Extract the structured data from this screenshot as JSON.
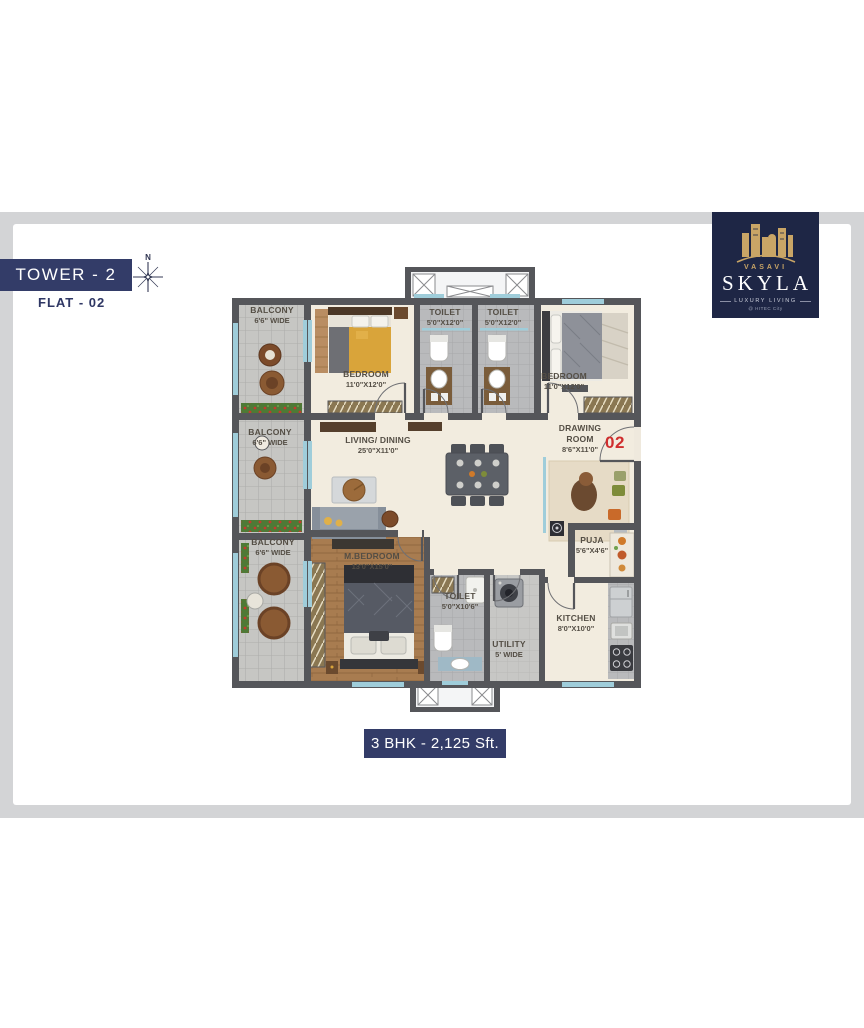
{
  "header": {
    "tower_label": "TOWER - 2",
    "flat_label": "FLAT - 02",
    "compass_north": "N"
  },
  "logo": {
    "brand": "VASAVI",
    "name": "SKYLA",
    "tagline": "LUXURY LIVING",
    "location": "@ HITEC City"
  },
  "plan": {
    "unit_number": "02",
    "rooms": {
      "balcony_top": {
        "name": "BALCONY",
        "dim": "6'6\" WIDE"
      },
      "bedroom_1": {
        "name": "BEDROOM",
        "dim": "11'0\"X12'0\""
      },
      "toilet_1": {
        "name": "TOILET",
        "dim": "5'0\"X12'0\""
      },
      "toilet_2": {
        "name": "TOILET",
        "dim": "5'0\"X12'0\""
      },
      "bedroom_2": {
        "name": "BEDROOM",
        "dim": "11'0\"X12'0\""
      },
      "balcony_mid": {
        "name": "BALCONY",
        "dim": "6'6\" WIDE"
      },
      "living_dining": {
        "name": "LIVING/ DINING",
        "dim": "25'0\"X11'0\""
      },
      "drawing_room": {
        "name": "DRAWING ROOM",
        "dim": "8'6\"X11'0\""
      },
      "balcony_bottom": {
        "name": "BALCONY",
        "dim": "6'6\" WIDE"
      },
      "master_bedroom": {
        "name": "M.BEDROOM",
        "dim": "13'0\"X15'0\""
      },
      "toilet_3": {
        "name": "TOILET",
        "dim": "5'0\"X10'6\""
      },
      "utility": {
        "name": "UTILITY",
        "dim": "5' WIDE"
      },
      "puja": {
        "name": "PUJA",
        "dim": "5'6\"X4'6\""
      },
      "kitchen": {
        "name": "KITCHEN",
        "dim": "8'0\"X10'0\""
      }
    }
  },
  "footer": {
    "summary": "3 BHK - 2,125 Sft."
  },
  "colors": {
    "navy": "#333c68",
    "logo_navy": "#1e2645",
    "gold": "#c9a566",
    "accent_red": "#cf2e2e",
    "wall": "#55565a",
    "floor": "#f2ecdf",
    "window_blue": "#9fcdda",
    "frame_gray": "#d3d4d6"
  }
}
